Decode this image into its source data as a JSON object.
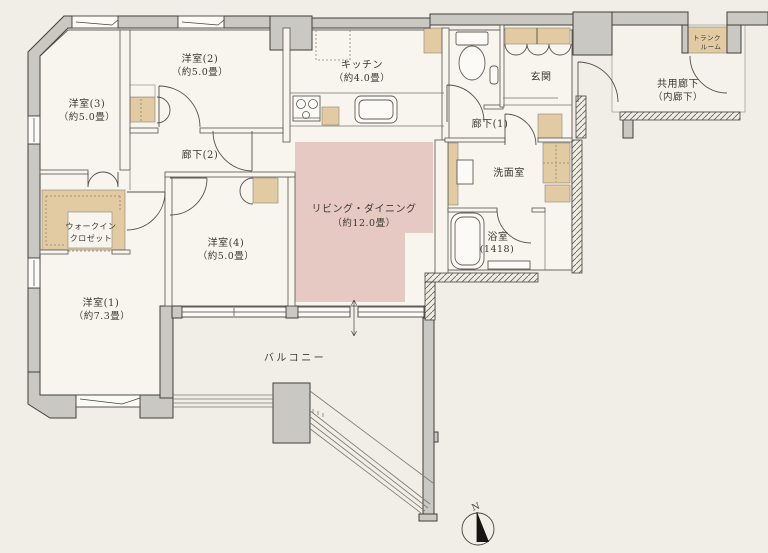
{
  "colors": {
    "background": "#f1eee7",
    "floor": "#f7f5ee",
    "wall": "#c9c8c3",
    "storage": "#e2cba3",
    "living_accent": "#e7c9c3",
    "line": "#55524b",
    "text": "#3b3933"
  },
  "rooms": {
    "living": {
      "name": "リビング・ダイニング",
      "size": "（約12.0畳）"
    },
    "kitchen": {
      "name": "キッチン",
      "size": "（約4.0畳）"
    },
    "bedroom1": {
      "name": "洋室(1)",
      "size": "（約7.3畳）"
    },
    "bedroom2": {
      "name": "洋室(2)",
      "size": "（約5.0畳）"
    },
    "bedroom3": {
      "name": "洋室(3)",
      "size": "（約5.0畳）"
    },
    "bedroom4": {
      "name": "洋室(4)",
      "size": "（約5.0畳）"
    },
    "hallway1": {
      "name": "廊下(1)"
    },
    "hallway2": {
      "name": "廊下(2)"
    },
    "entrance": {
      "name": "玄関"
    },
    "walk_in_closet": {
      "line1": "ウォークイン",
      "line2": "クロゼット"
    },
    "washroom": {
      "name": "洗面室"
    },
    "bathroom": {
      "name": "浴室",
      "size": "(1418)"
    },
    "balcony": {
      "name": "バルコニー"
    },
    "trunk_room": {
      "line1": "トランク",
      "line2": "ルーム"
    },
    "shared_corridor": {
      "name": "共用廊下",
      "size": "（内廊下）"
    }
  },
  "compass": {
    "north_label": "N"
  }
}
